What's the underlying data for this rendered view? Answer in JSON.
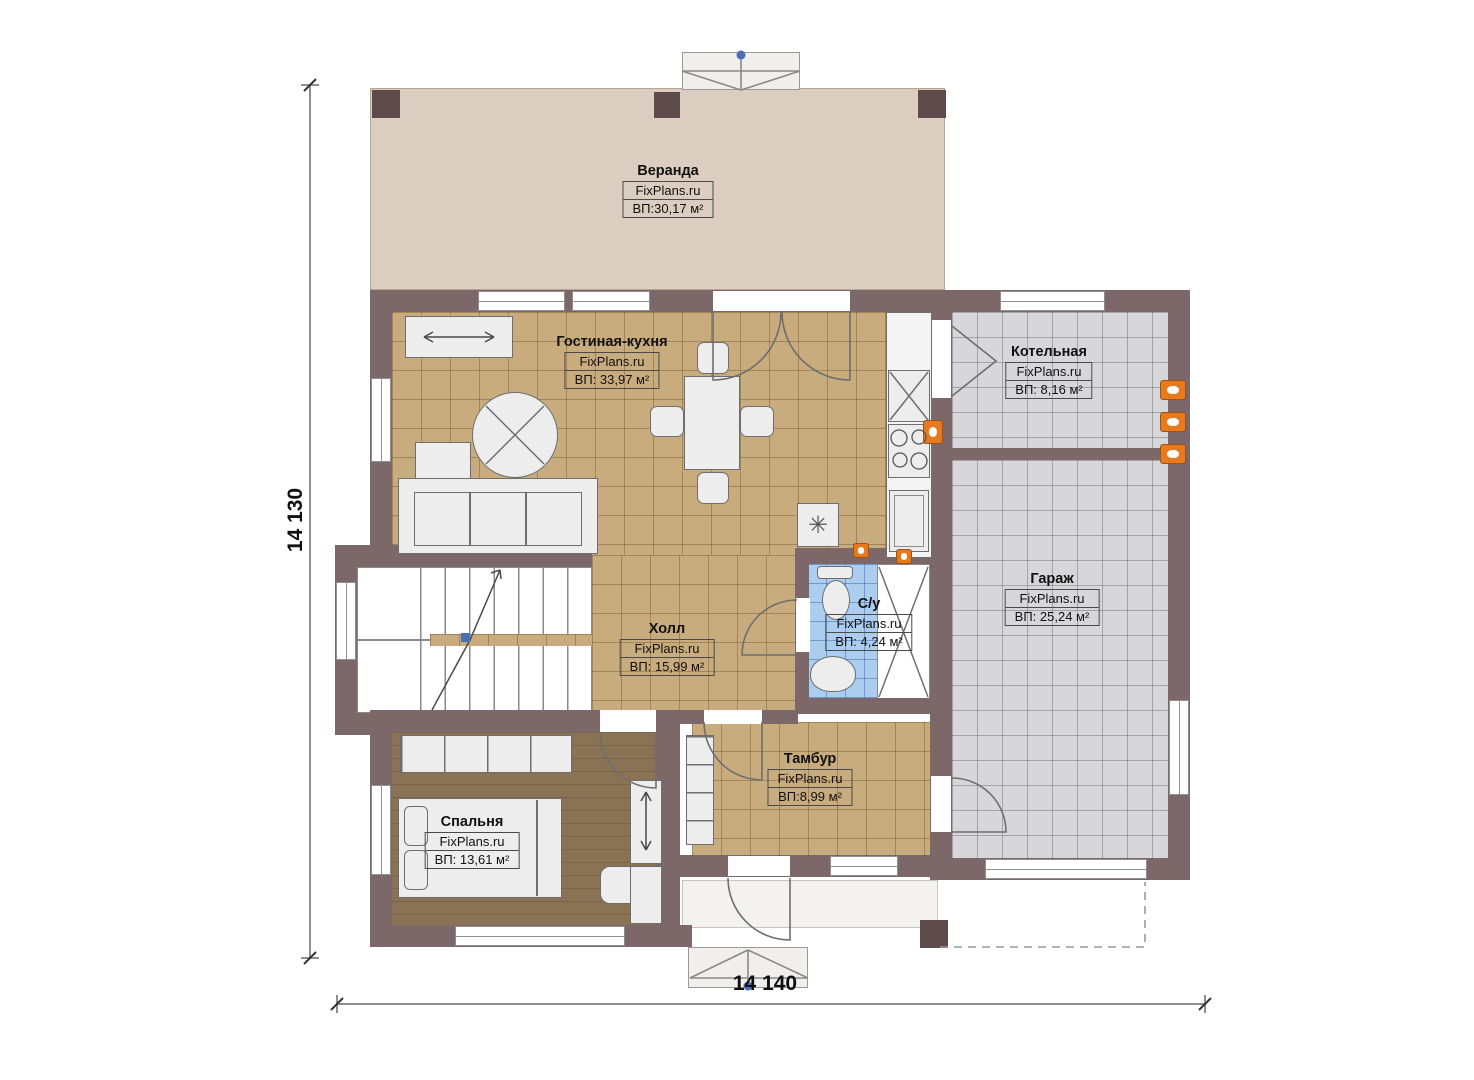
{
  "plan": {
    "dimensions": {
      "height_label": "14 130",
      "width_label": "14 140"
    },
    "brand": "FixPlans.ru",
    "rooms": [
      {
        "key": "veranda",
        "name": "Веранда",
        "brand": "FixPlans.ru",
        "area": "ВП:30,17 м²"
      },
      {
        "key": "living-kitchen",
        "name": "Гостиная-кухня",
        "brand": "FixPlans.ru",
        "area": "ВП: 33,97 м²"
      },
      {
        "key": "boiler",
        "name": "Котельная",
        "brand": "FixPlans.ru",
        "area": "ВП: 8,16 м²"
      },
      {
        "key": "garage",
        "name": "Гараж",
        "brand": "FixPlans.ru",
        "area": "ВП: 25,24 м²"
      },
      {
        "key": "hall",
        "name": "Холл",
        "brand": "FixPlans.ru",
        "area": "ВП: 15,99 м²"
      },
      {
        "key": "wc",
        "name": "С/у",
        "brand": "FixPlans.ru",
        "area": "ВП: 4,24 м²"
      },
      {
        "key": "tambour",
        "name": "Тамбур",
        "brand": "FixPlans.ru",
        "area": "ВП:8,99 м²"
      },
      {
        "key": "bedroom",
        "name": "Спальня",
        "brand": "FixPlans.ru",
        "area": "ВП: 13,61 м²"
      }
    ],
    "icons": {
      "snowflake": "✳"
    },
    "colors": {
      "wall": "#7c6769",
      "floor_tan": "#c9ac7e",
      "floor_gray": "#d7d7d9",
      "floor_blue": "#abcdf0",
      "floor_bedroom": "#8a7254",
      "floor_veranda": "#dbcec0",
      "accent_orange": "#e87a1e",
      "marker_blue": "#4a6fb5"
    }
  }
}
